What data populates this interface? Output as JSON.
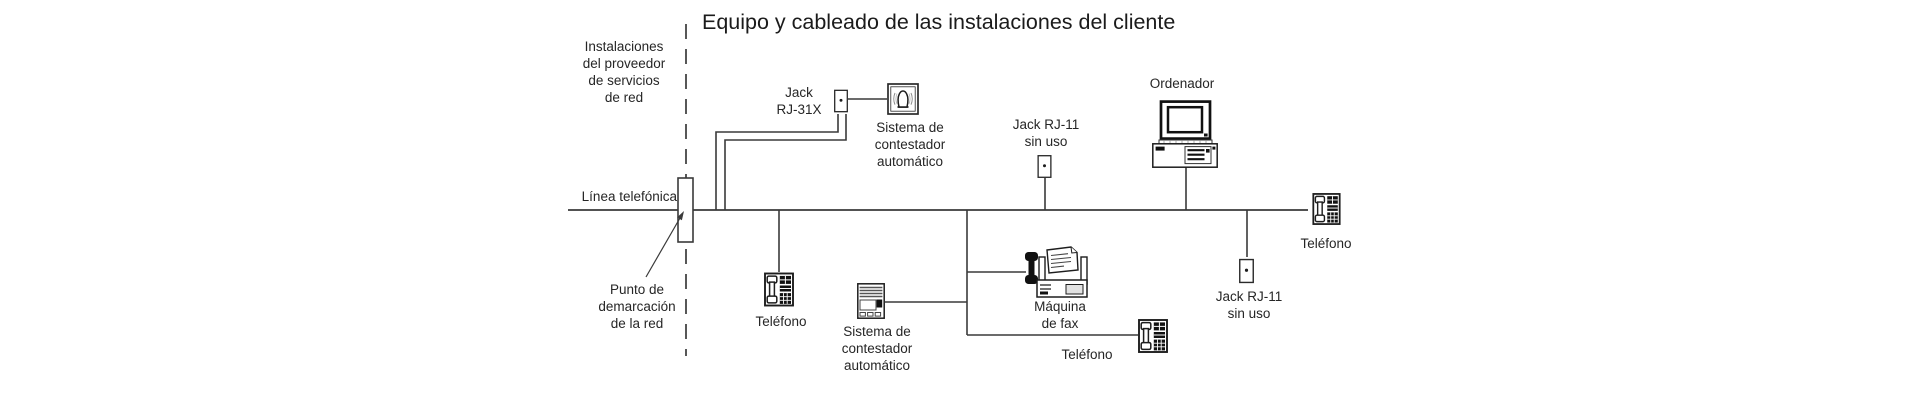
{
  "title": "Equipo y cableado de las instalaciones del cliente",
  "regions": {
    "provider_premises": "Instalaciones\ndel proveedor\nde servicios\nde red",
    "phone_line": "Línea telefónica",
    "demarcation_point": "Punto de\ndemarcación\nde la red"
  },
  "nodes": {
    "jack_rj31x": "Jack\nRJ-31X",
    "answering_system_top": "Sistema de\ncontestador\nautomático",
    "jack_rj11_unused_top": "Jack RJ-11\nsin uso",
    "computer": "Ordenador",
    "phone_right": "Teléfono",
    "phone_left": "Teléfono",
    "answering_system_bottom": "Sistema de\ncontestador\nautomático",
    "fax_machine": "Máquina\nde fax",
    "phone_middle": "Teléfono",
    "jack_rj11_unused_bottom": "Jack RJ-11\nsin uso"
  },
  "colors": {
    "background": "#ffffff",
    "line": "#3a3a3a",
    "text": "#262626"
  }
}
